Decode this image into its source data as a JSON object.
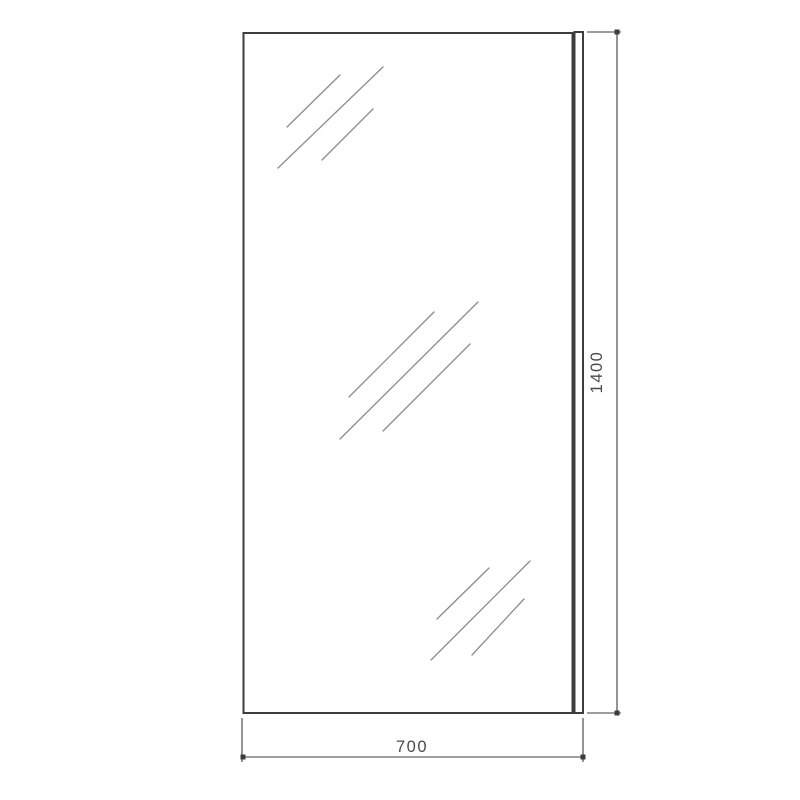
{
  "drawing": {
    "dimensions": {
      "height_label": "1400",
      "width_label": "700"
    }
  },
  "colors": {
    "background": "#ffffff",
    "outline": "#3d3d3d",
    "hatch": "#8c8c8c",
    "dimension": "#3d3d3d",
    "label": "#4a4a4a"
  }
}
